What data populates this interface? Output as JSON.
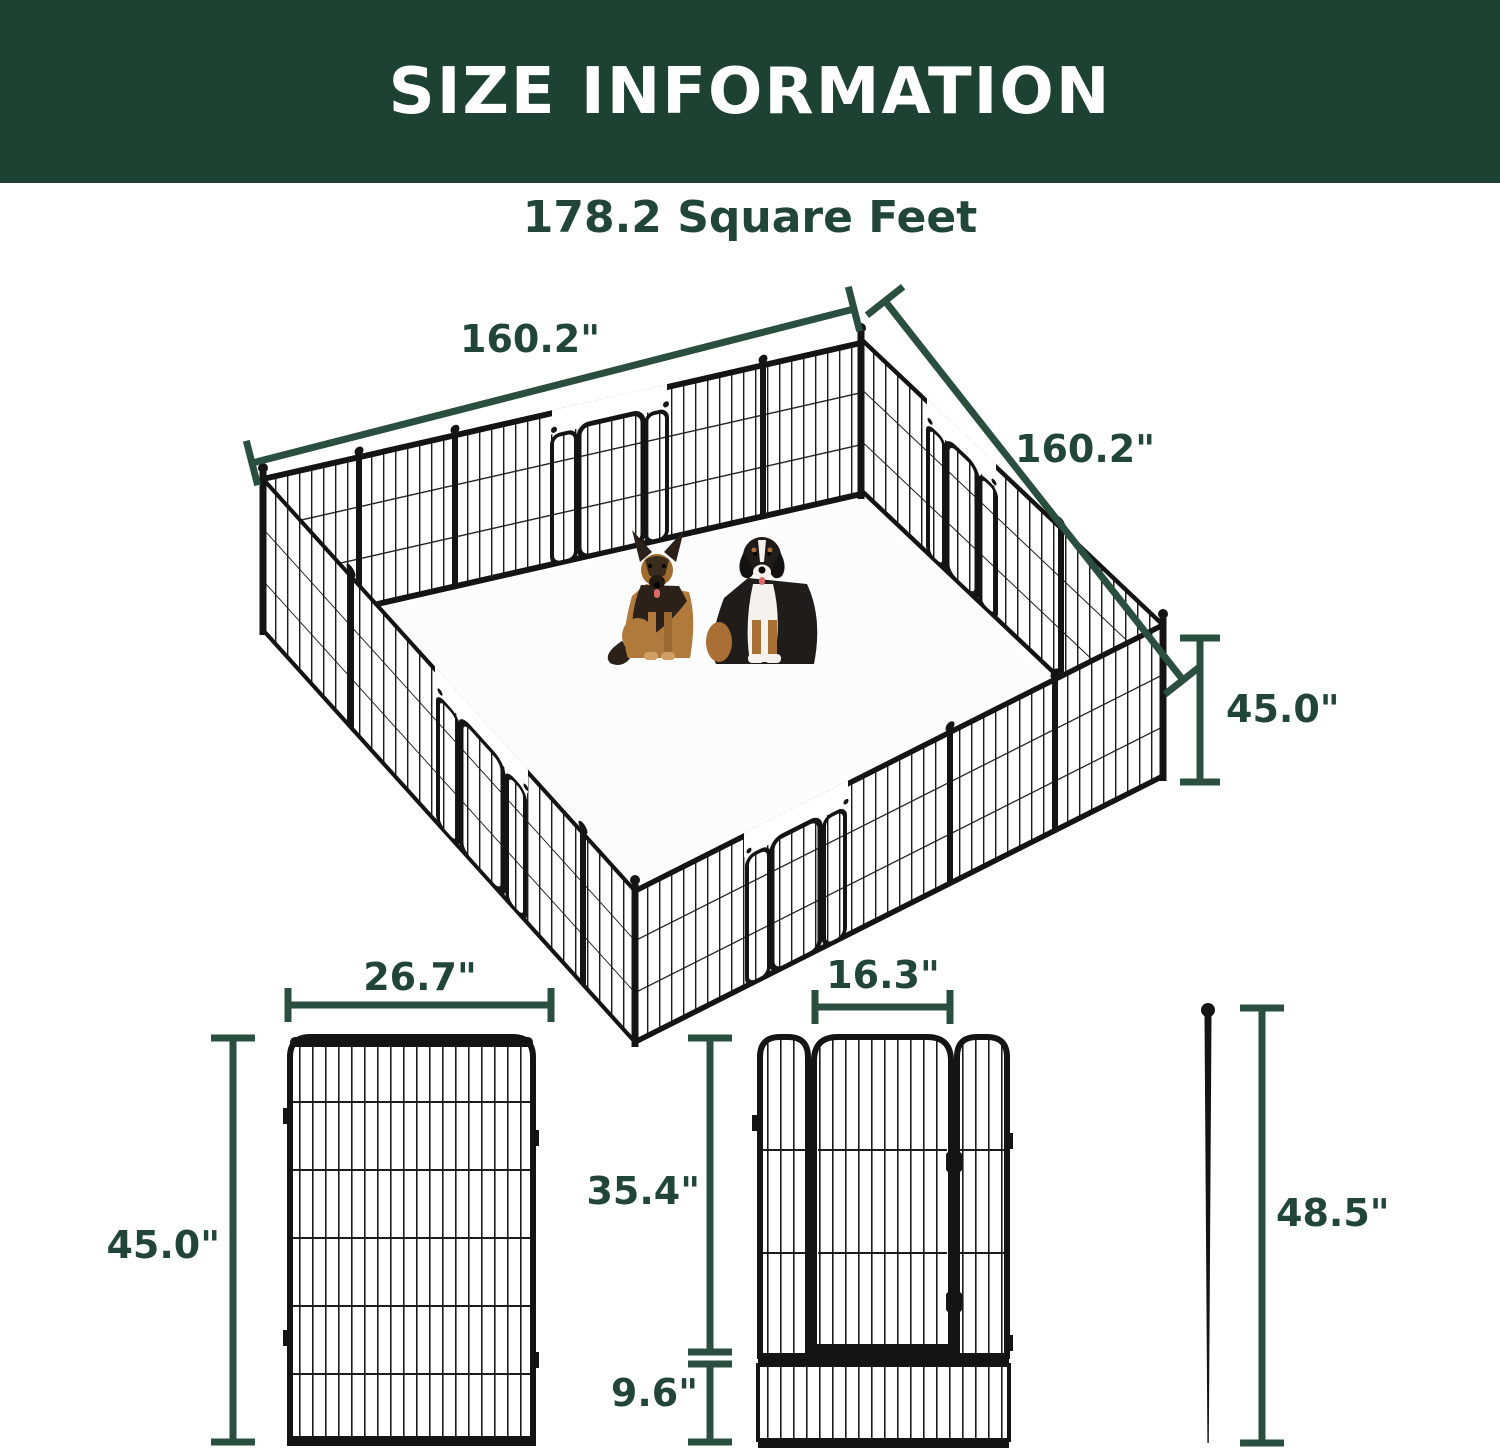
{
  "header": {
    "title": "SIZE INFORMATION",
    "bg_color": "#1d4232",
    "text_color": "#ffffff"
  },
  "subtitle": {
    "text": "178.2 Square Feet"
  },
  "colors": {
    "accent_text": "#214639",
    "dimension_line": "#2a4f3e",
    "fence": "#141414"
  },
  "pen_diagram": {
    "width_label": "160.2\"",
    "depth_label": "160.2\"",
    "height_label": "45.0\"",
    "dogs": [
      "german-shepherd",
      "bernese-mountain-dog"
    ]
  },
  "panel_diagram": {
    "width_label": "26.7\"",
    "height_label": "45.0\""
  },
  "door_panel_diagram": {
    "door_width_label": "16.3\"",
    "door_height_label": "35.4\"",
    "bottom_height_label": "9.6\""
  },
  "stake_diagram": {
    "height_label": "48.5\""
  }
}
